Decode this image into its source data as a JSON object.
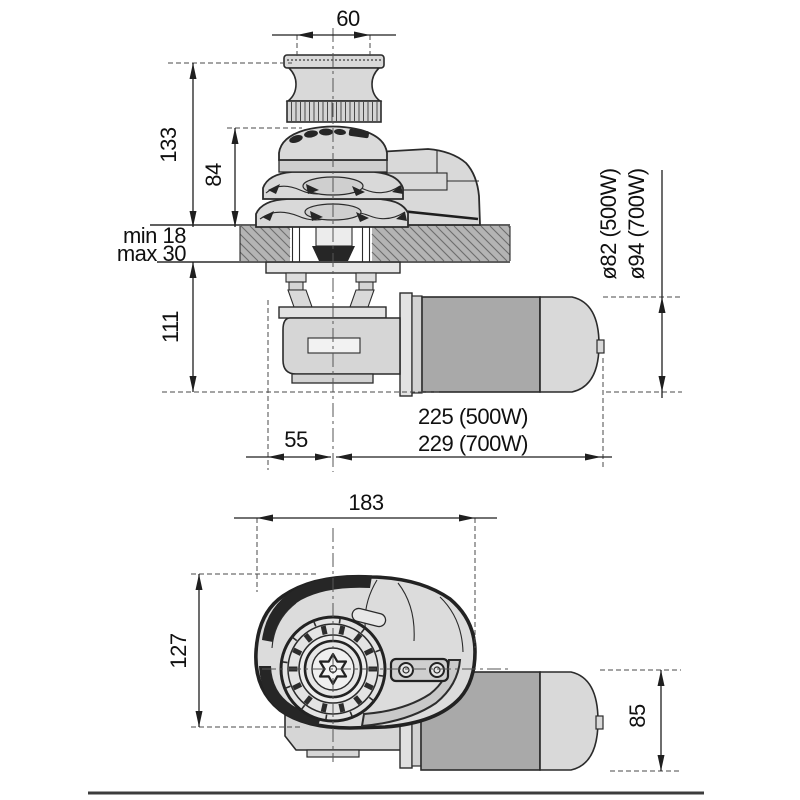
{
  "drawing": {
    "kind": "windlass dimensional drawing",
    "side_view": {
      "labels": {
        "capstan_width": "60",
        "overall_height": "133",
        "gypsy_height": "84",
        "deck_min": "min 18",
        "deck_max": "max 30",
        "below_deck_height": "111",
        "center_offset": "55",
        "length_500w": "225 (500W)",
        "length_700w": "229 (700W)",
        "motor_diameter_500w": "ø82 (500W)",
        "motor_diameter_700w": "ø94 (700W)"
      }
    },
    "front_view": {
      "labels": {
        "overall_width": "183",
        "overall_height": "127",
        "motor_height": "85"
      }
    },
    "colors": {
      "line": "#2b2b2b",
      "light_fill": "#d9d9d9",
      "deck_fill": "#b4b4b4",
      "motor_fill": "#a9a9a9",
      "dark_accent": "#2d2d2d"
    }
  }
}
